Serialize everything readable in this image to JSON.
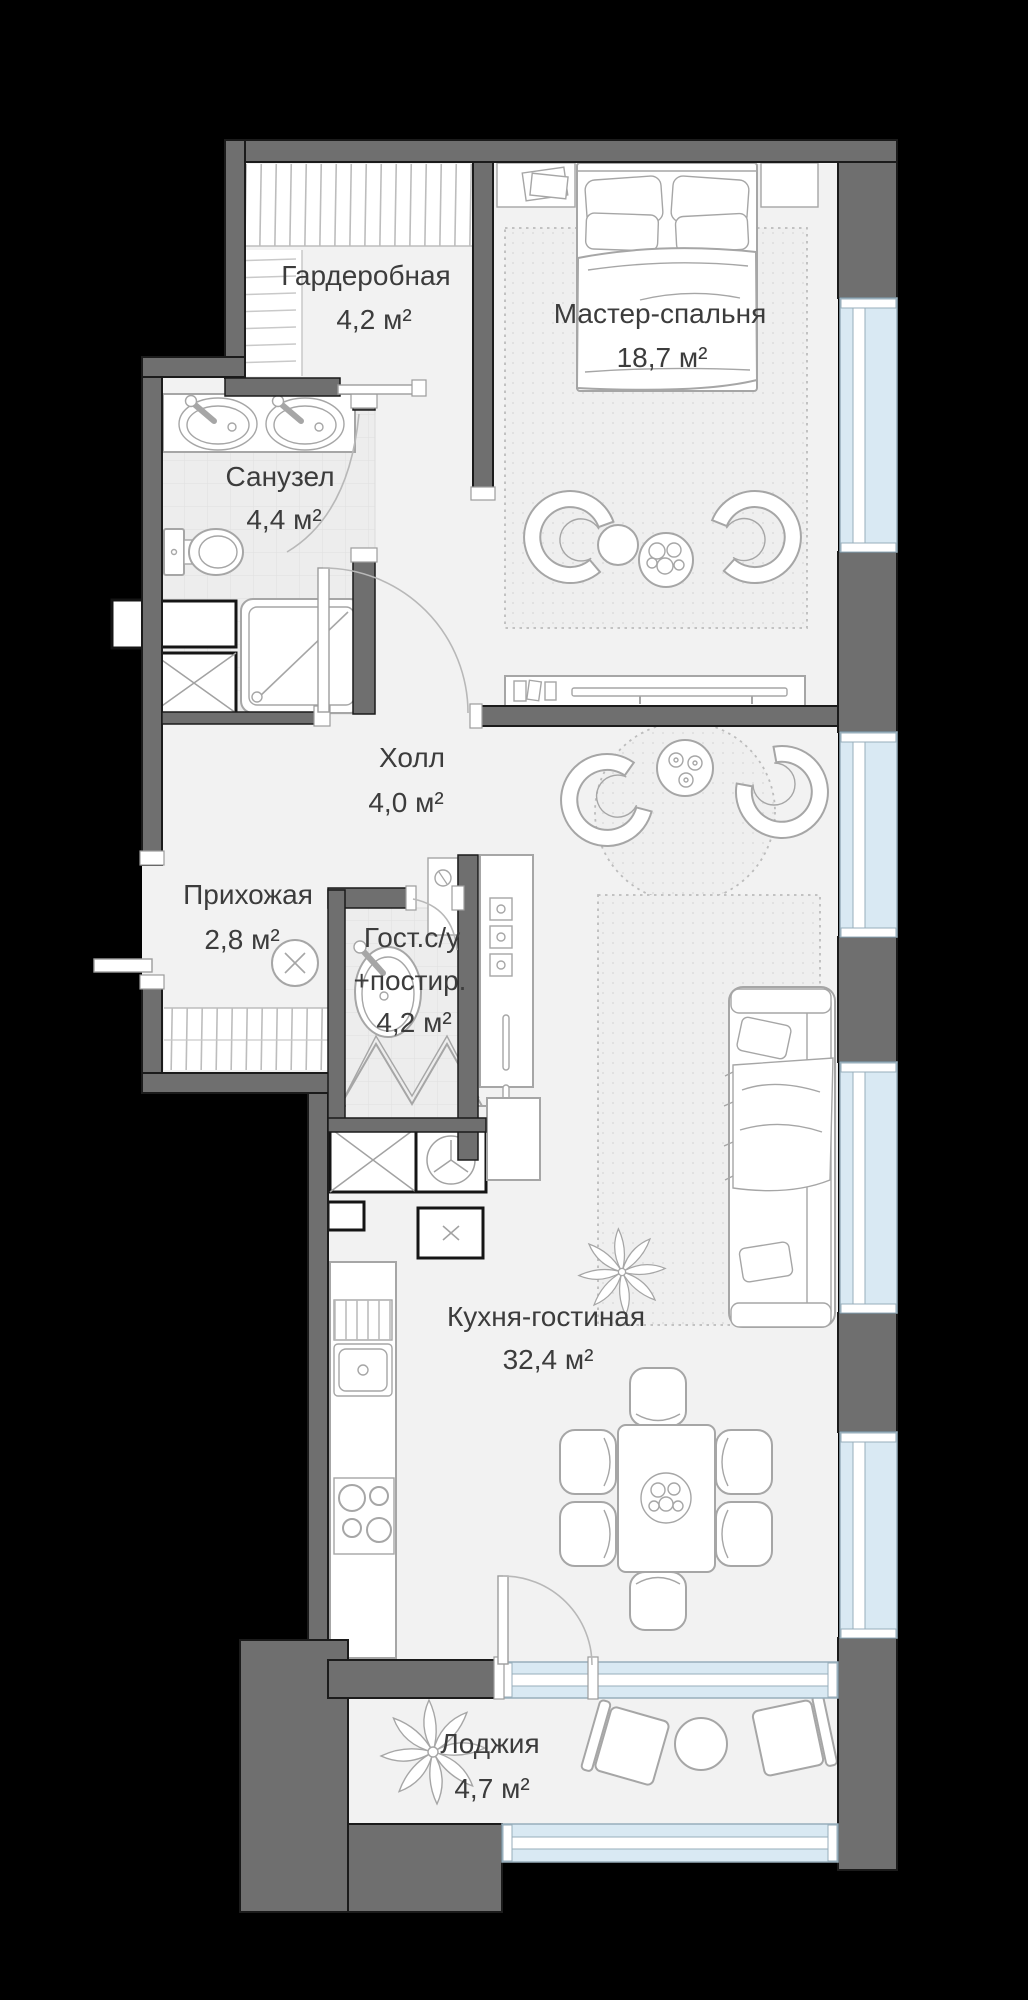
{
  "plan": {
    "type": "apartment-floor-plan",
    "rooms": {
      "wardrobe": {
        "name": "Гардеробная",
        "area": "4,2 м²"
      },
      "master_bedroom": {
        "name": "Мастер-спальня",
        "area": "18,7 м²"
      },
      "bathroom": {
        "name": "Санузел",
        "area": "4,4 м²"
      },
      "hall": {
        "name": "Холл",
        "area": "4,0 м²"
      },
      "entry": {
        "name": "Прихожая",
        "area": "2,8 м²"
      },
      "guest_wc": {
        "name_line1": "Гост.с/у",
        "name_line2": "+постир.",
        "area": "4,2 м²"
      },
      "kitchen_living": {
        "name": "Кухня-гостиная",
        "area": "32,4 м²"
      },
      "loggia": {
        "name": "Лоджия",
        "area": "4,7 м²"
      }
    },
    "colors": {
      "background": "#000000",
      "wall": "#6f6f6f",
      "wall_outline": "#1b1b1b",
      "floor": "#f2f2f2",
      "tile_floor": "#ededed",
      "window_glass": "#d9e9f3",
      "furniture_stroke": "#a6a6a6",
      "label_text": "#3c3c3c"
    }
  }
}
